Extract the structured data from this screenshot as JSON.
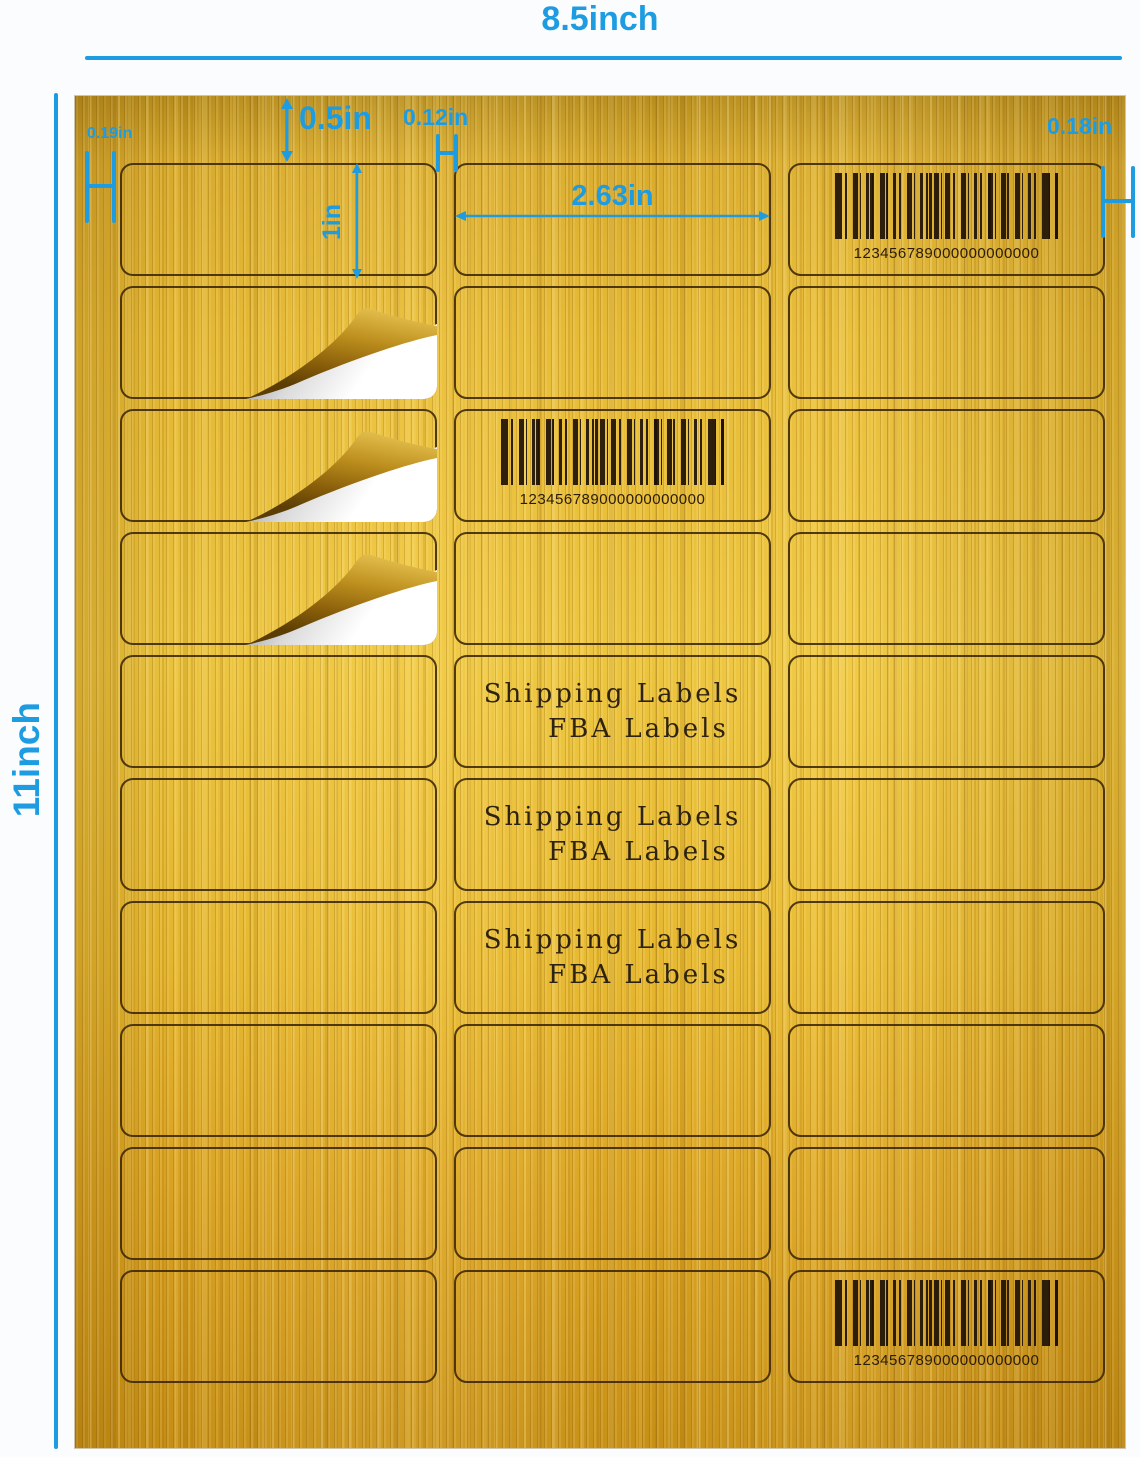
{
  "annotations": {
    "sheet_width": "8.5inch",
    "sheet_height": "11inch",
    "top_margin": "0.5in",
    "column_gap": "0.12in",
    "left_margin": "0.19in",
    "right_margin": "0.18in",
    "label_height": "1in",
    "label_width": "2.63in"
  },
  "labels": {
    "barcode_value": "123456789000000000000",
    "shipping_line1": "Shipping Labels",
    "shipping_line2": "FBA Labels"
  },
  "grid": {
    "rows": 10,
    "columns": 3,
    "barcode_cells": "r1c3, r3c2, r10c3",
    "text_cells": "r5c2, r6c2, r7c2",
    "peel_cells": "r2c1, r3c1, r4c1"
  },
  "colors": {
    "accent_blue": "#1e9ce2",
    "gold_base": "#eebb33",
    "gold_dark": "#c99115",
    "label_outline": "#3a2507",
    "barcode_ink": "#1e1206",
    "page_background": "#fbfcfd"
  }
}
